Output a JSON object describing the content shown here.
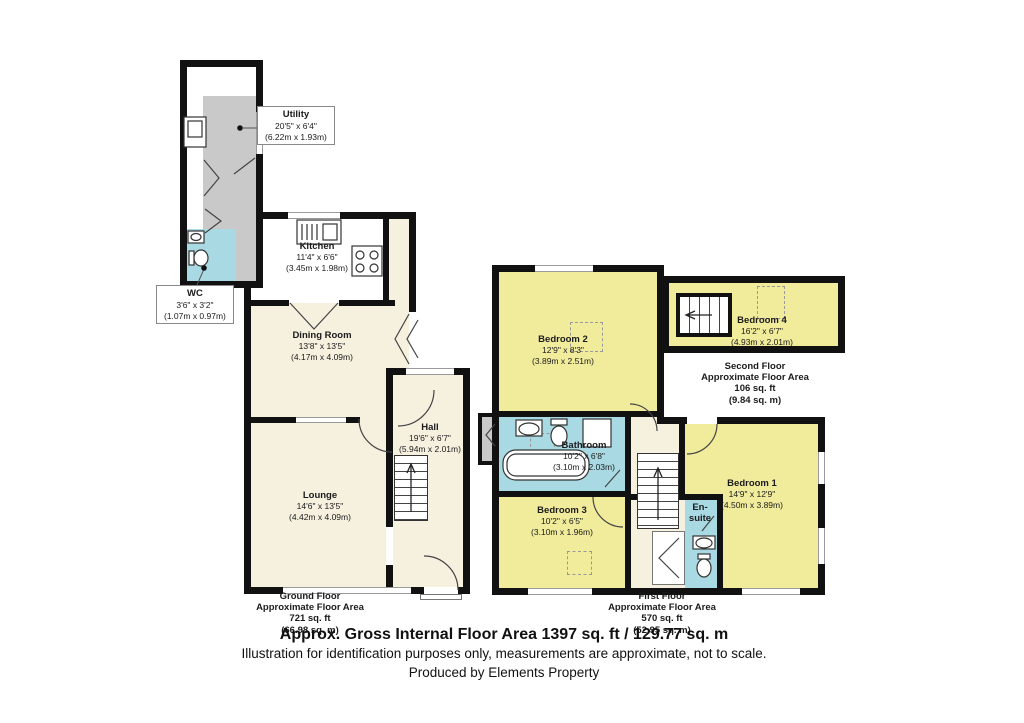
{
  "title": "Floor plan",
  "rooms": {
    "utility": {
      "name": "Utility",
      "ft": "20'5\" x 6'4\"",
      "m": "(6.22m x 1.93m)"
    },
    "wc": {
      "name": "WC",
      "ft": "3'6\" x 3'2\"",
      "m": "(1.07m x 0.97m)"
    },
    "kitchen": {
      "name": "Kitchen",
      "ft": "11'4\" x 6'6\"",
      "m": "(3.45m x 1.98m)"
    },
    "dining": {
      "name": "Dining Room",
      "ft": "13'8\" x 13'5\"",
      "m": "(4.17m x 4.09m)"
    },
    "hall": {
      "name": "Hall",
      "ft": "19'6\" x 6'7\"",
      "m": "(5.94m x 2.01m)"
    },
    "lounge": {
      "name": "Lounge",
      "ft": "14'6\" x 13'5\"",
      "m": "(4.42m x 4.09m)"
    },
    "bedroom2": {
      "name": "Bedroom 2",
      "ft": "12'9\" x 8'3\"",
      "m": "(3.89m x 2.51m)"
    },
    "bathroom": {
      "name": "Bathroom",
      "ft": "10'2\" x 6'8\"",
      "m": "(3.10m x 2.03m)"
    },
    "bedroom3": {
      "name": "Bedroom 3",
      "ft": "10'2\" x 6'5\"",
      "m": "(3.10m x 1.96m)"
    },
    "bedroom1": {
      "name": "Bedroom 1",
      "ft": "14'9\" x 12'9\"",
      "m": "(4.50m x 3.89m)"
    },
    "ensuite": {
      "l1": "En-",
      "l2": "suite"
    },
    "bedroom4": {
      "name": "Bedroom 4",
      "ft": "16'2\" x 6'7\"",
      "m": "(4.93m x 2.01m)"
    }
  },
  "floors": {
    "ground": {
      "l1": "Ground Floor",
      "l2": "Approximate Floor Area",
      "l3": "721 sq. ft",
      "l4": "(66.98 sq. m)"
    },
    "first": {
      "l1": "First Floor",
      "l2": "Approximate Floor Area",
      "l3": "570 sq. ft",
      "l4": "(52.95 sq. m)"
    },
    "second": {
      "l1": "Second Floor",
      "l2": "Approximate Floor Area",
      "l3": "106 sq. ft",
      "l4": "(9.84 sq. m)"
    }
  },
  "footer": {
    "total": "Approx. Gross Internal Floor Area 1397 sq. ft / 129.77 sq. m",
    "disclaimer": "Illustration for identification purposes only, measurements are approximate, not to scale.",
    "producer": "Produced by Elements Property"
  },
  "colors": {
    "wall": "#111111",
    "floor_cream": "#f6f0df",
    "bedroom_yellow": "#f1ec9c",
    "wet_room_blue": "#a9dae4",
    "utility_gray": "#c9c9c9"
  }
}
